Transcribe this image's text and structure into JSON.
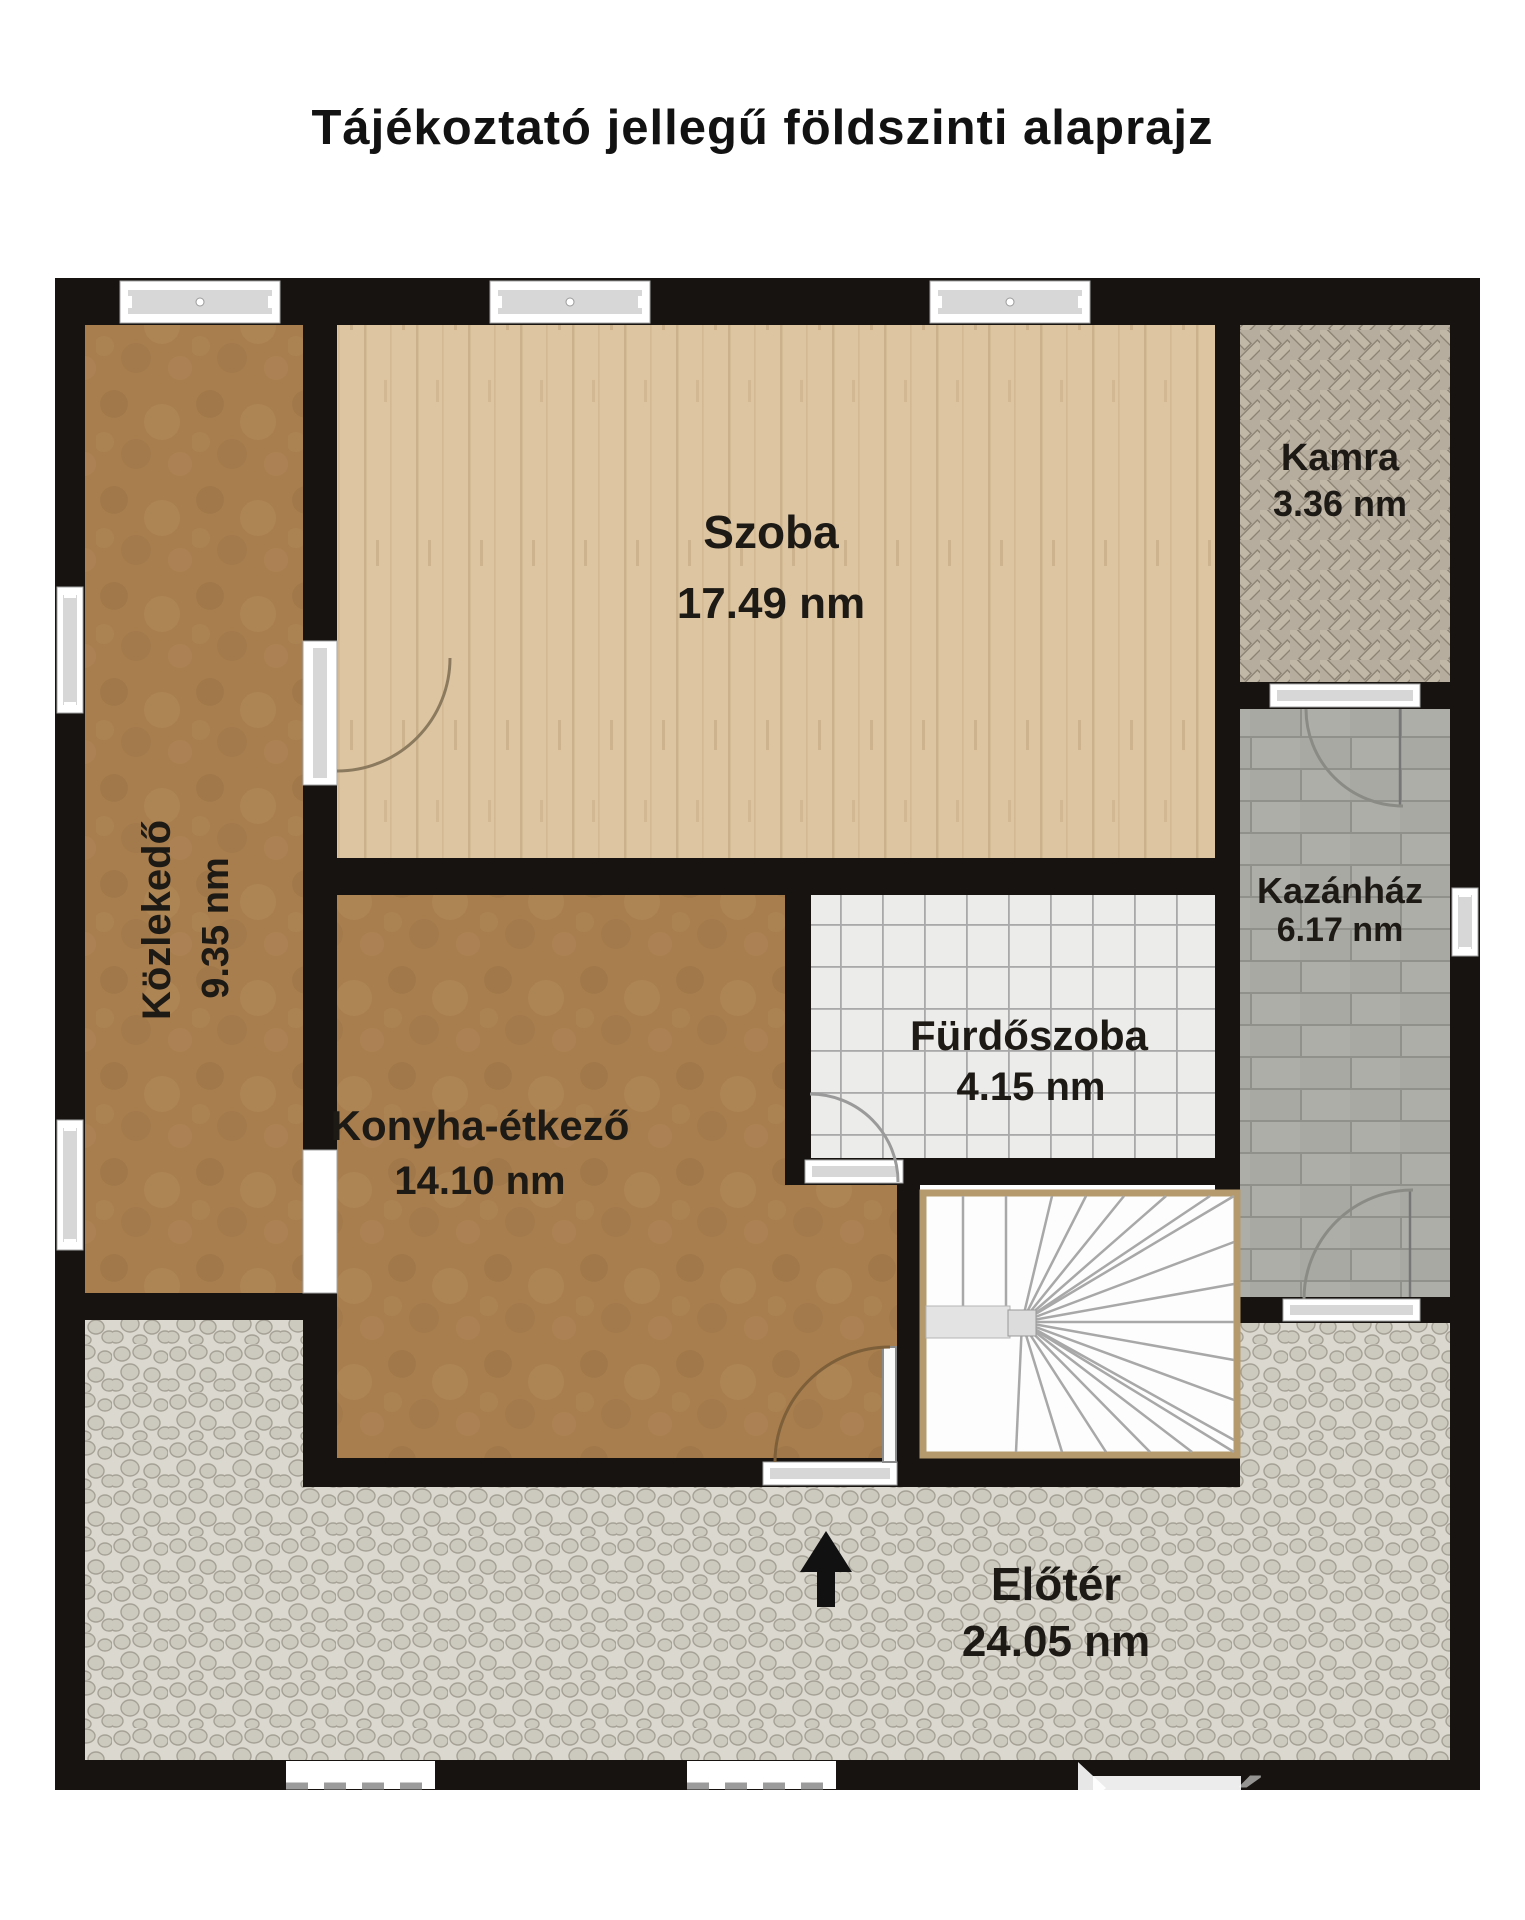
{
  "title": "Tájékoztató jellegű földszinti alaprajz",
  "unit_suffix": "nm",
  "rooms": {
    "szoba": {
      "name": "Szoba",
      "area": "17.49 nm"
    },
    "kamra": {
      "name": "Kamra",
      "area": "3.36 nm"
    },
    "kozlekedo": {
      "name": "Közlekedő",
      "area": "9.35 nm"
    },
    "furdoszoba": {
      "name": "Fürdőszoba",
      "area": "4.15 nm"
    },
    "konyha": {
      "name": "Konyha-étkező",
      "area": "14.10 nm"
    },
    "kazanhaz": {
      "name": "Kazánház",
      "area": "6.17 nm"
    },
    "eloter": {
      "name": "Előtér",
      "area": "24.05 nm"
    }
  },
  "entrance_arrow": {
    "direction": "up"
  },
  "watermark": "VÁROSI",
  "colors": {
    "wall": "#161310",
    "wood_floor": "#ddc5a2",
    "brown_floor": "#a87e4e",
    "bath_tile": "#ececea",
    "stone_tile": "#a9a9a4",
    "cobblestone": "#dbd8d0",
    "herringbone": "#b7ad9e",
    "label_text": "#1d1a16"
  }
}
